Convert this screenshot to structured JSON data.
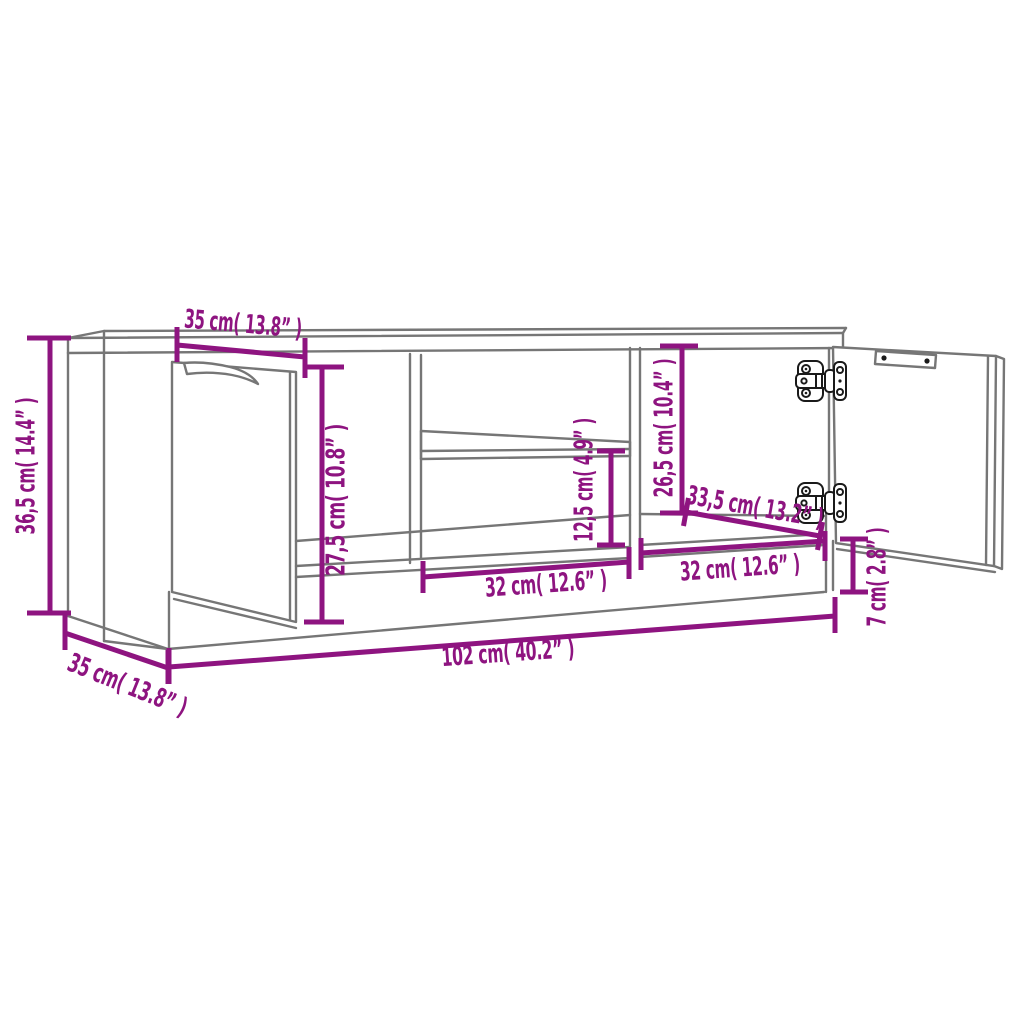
{
  "diagram": {
    "kind": "furniture-dimension-line-drawing",
    "background": "#ffffff",
    "colors": {
      "dimension": "#8E1480",
      "outline": "#767676",
      "hardware": "#1a1a1a"
    },
    "dimensions": {
      "overall_height": {
        "label": "36,5 cm( 14.4” )",
        "cm": 36.5,
        "inch": 14.4
      },
      "top_depth": {
        "label": "35 cm( 13.8” )",
        "cm": 35,
        "inch": 13.8
      },
      "door_height": {
        "label": "27,5 cm( 10.8” )",
        "cm": 27.5,
        "inch": 10.8
      },
      "shelf_clearance": {
        "label": "12,5 cm( 4.9” )",
        "cm": 12.5,
        "inch": 4.9
      },
      "inner_height": {
        "label": "26,5 cm( 10.4” )",
        "cm": 26.5,
        "inch": 10.4
      },
      "inner_depth": {
        "label": "33,5 cm( 13.2” )",
        "cm": 33.5,
        "inch": 13.2
      },
      "middle_compartment_width": {
        "label": "32 cm( 12.6” )",
        "cm": 32,
        "inch": 12.6
      },
      "right_compartment_width": {
        "label": "32 cm( 12.6” )",
        "cm": 32,
        "inch": 12.6
      },
      "plinth_height": {
        "label": "7 cm( 2.8” )",
        "cm": 7,
        "inch": 2.8
      },
      "overall_width": {
        "label": "102 cm( 40.2” )",
        "cm": 102,
        "inch": 40.2
      },
      "bottom_depth": {
        "label": "35 cm( 13.8” )",
        "cm": 35,
        "inch": 13.8
      }
    }
  }
}
